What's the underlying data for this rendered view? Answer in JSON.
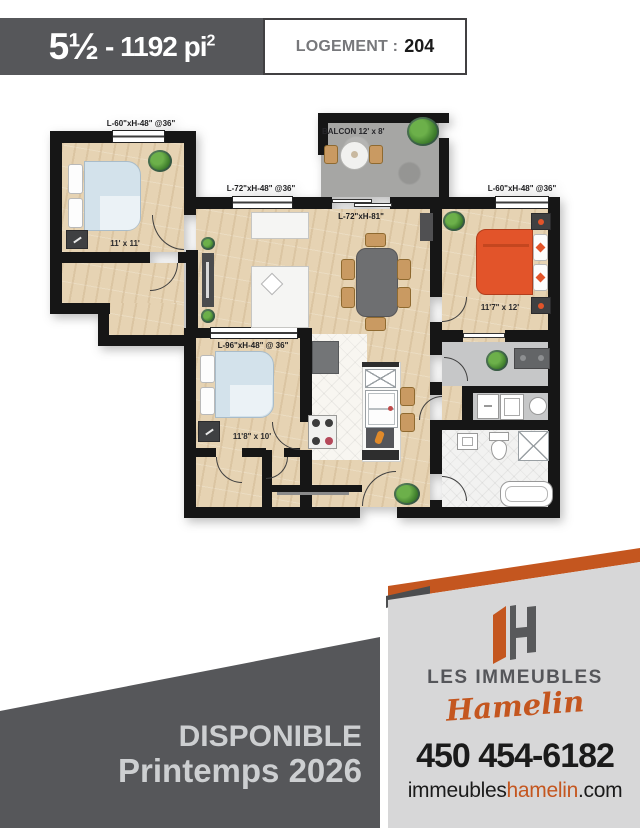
{
  "header": {
    "unit_type": "5½",
    "unit_sep": "-",
    "area": "1192 pi",
    "area_sup": "2",
    "logement_label": "LOGEMENT :",
    "logement_number": "204"
  },
  "floorplan": {
    "balcony": "BALCON 12' x 8'",
    "windows": {
      "bedroom1": "L-60\"xH-48\" @36\"",
      "living": "L-72\"xH-48\" @36\"",
      "patio_door": "L-72\"xH-81\"",
      "bedroom3": "L-60\"xH-48\" @36\"",
      "bedroom2": "L-96\"xH-48\" @ 36\""
    },
    "rooms": {
      "bedroom1": "11' x 11'",
      "bedroom2": "11'8\" x 10'",
      "bedroom3": "11'7\" x 12'"
    }
  },
  "footer": {
    "availability": {
      "line1": "DISPONIBLE",
      "line2": "Printemps 2026"
    },
    "brand": {
      "line1": "LES IMMEUBLES",
      "line2": "Hamelin"
    },
    "phone": "450 454-6182",
    "website": {
      "part1": "immeubles",
      "part2": "hamelin",
      "part3": ".com"
    }
  },
  "colors": {
    "accent_orange": "#c4561f",
    "banner_gray": "#56575a",
    "panel_gray": "#d7d7d8",
    "wall_black": "#161616",
    "wood_floor": "#e6d3b3",
    "bed_blue": "#d3e2eb",
    "bed_orange": "#e2542a"
  }
}
